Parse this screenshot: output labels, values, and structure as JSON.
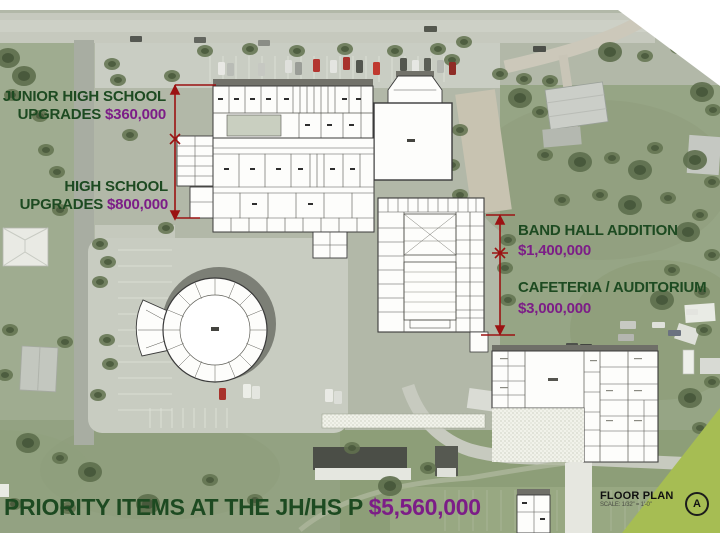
{
  "labels": {
    "junior_high": {
      "line1": "JUNIOR HIGH SCHOOL",
      "line2_prefix": "UPGRADES ",
      "amount": "$360,000"
    },
    "high_school": {
      "line1": "HIGH SCHOOL",
      "line2_prefix": "UPGRADES ",
      "amount": "$800,000"
    },
    "band_hall": {
      "line1": "BAND HALL ADDITION",
      "amount": "$1,400,000"
    },
    "cafeteria_auditorium": {
      "line1": "CAFETERIA / AUDITORIUM",
      "amount": "$3,000,000"
    }
  },
  "footer": {
    "title_prefix": "PRIORITY ITEMS AT THE JH/HS P ",
    "total_amount": "$5,560,000"
  },
  "title_block": {
    "drawing_title": "FLOOR PLAN",
    "drawing_scale": "SCALE: 1/32\" = 1'-0\"",
    "sheet_letter": "A"
  },
  "colors": {
    "label_green": "#1d4a21",
    "amount_purple": "#7c1d87",
    "dimension_red": "#9b1212",
    "sheet_wedge_green": "#a6bd53"
  }
}
